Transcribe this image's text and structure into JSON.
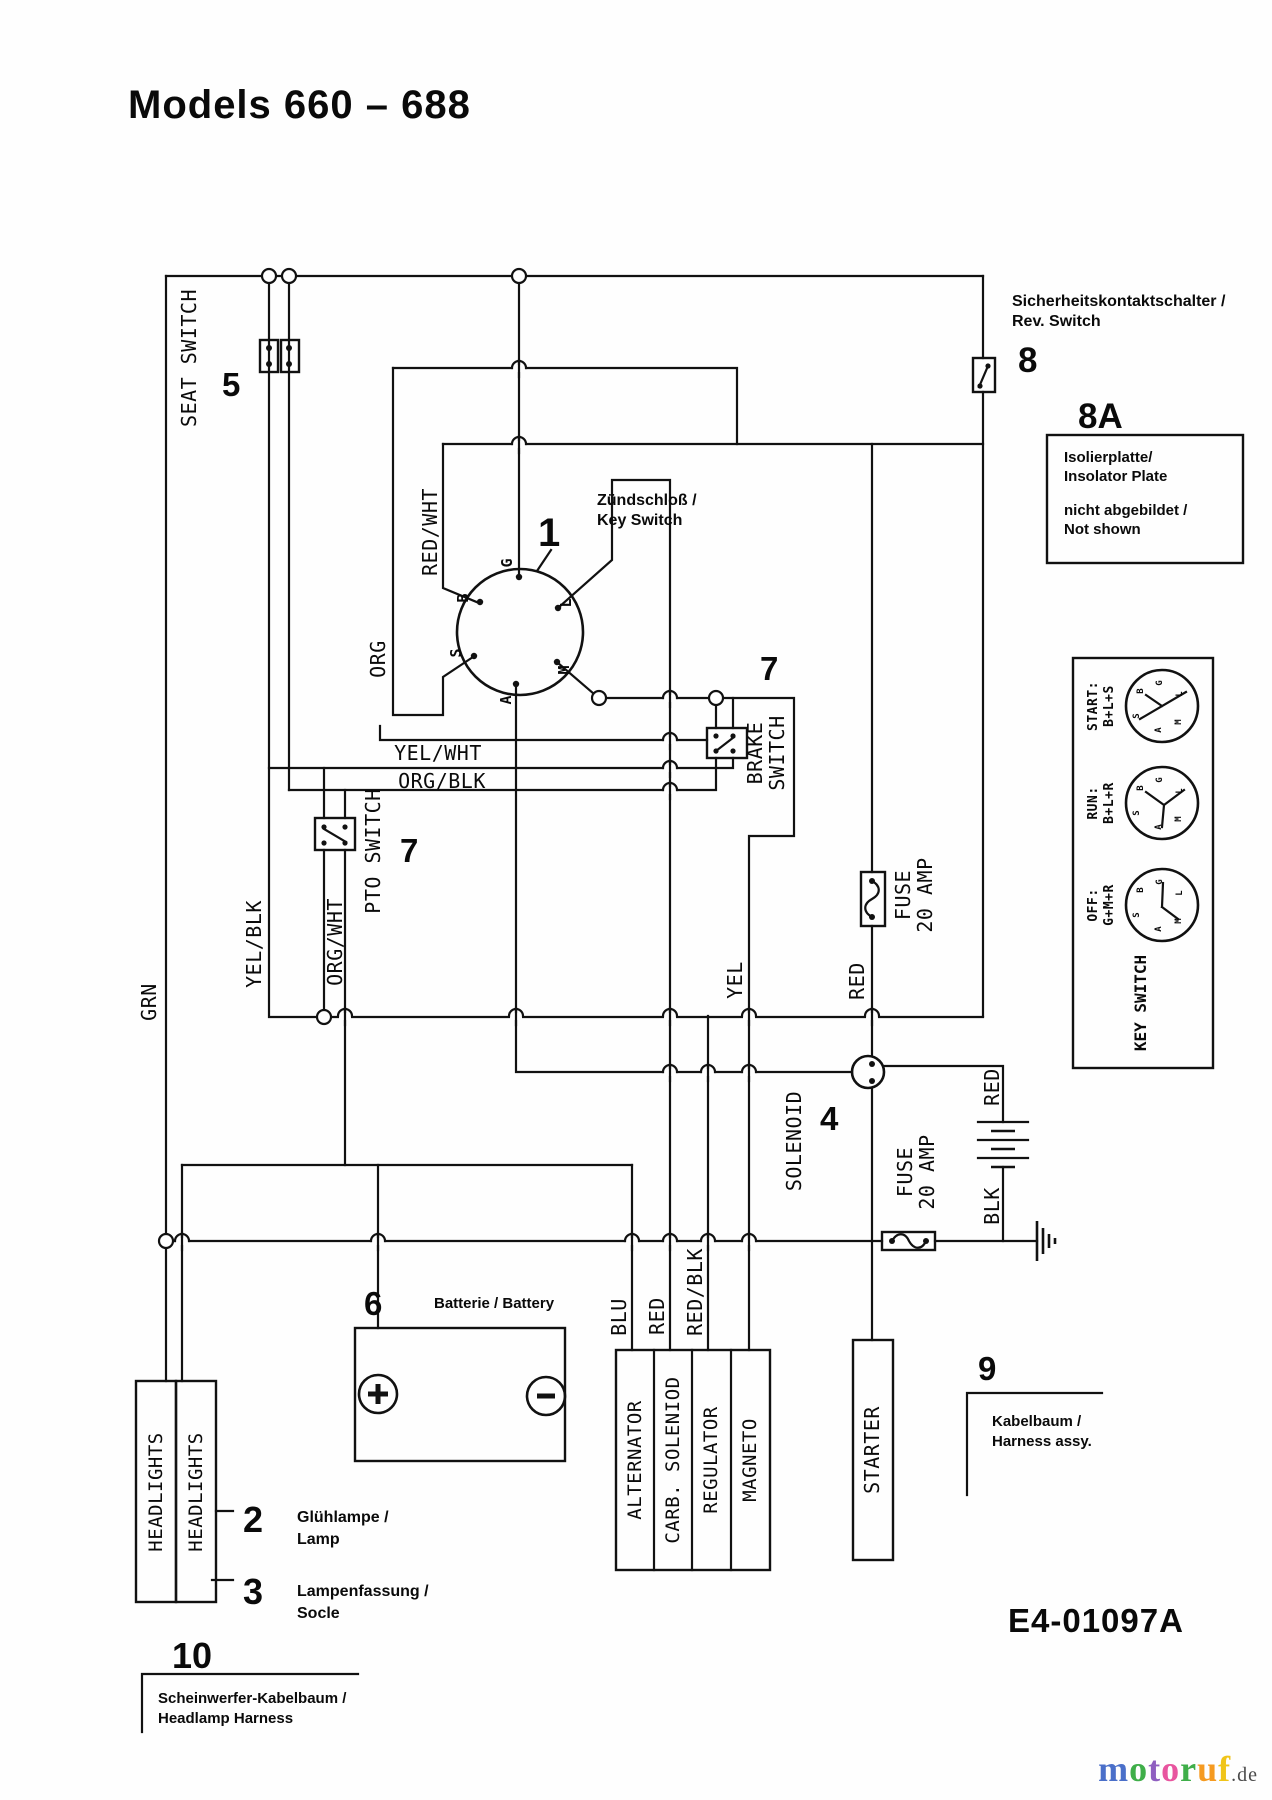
{
  "title": "Models 660 – 688",
  "numbers": {
    "n1": "1",
    "n2": "2",
    "n3": "3",
    "n4": "4",
    "n5": "5",
    "n6": "6",
    "n7_pto": "7",
    "n7_brake": "7",
    "n8": "8",
    "n8a": "8A",
    "n9": "9",
    "n10": "10"
  },
  "labels": {
    "seat_switch": "SEAT SWITCH",
    "grn": "GRN",
    "yel_blk": "YEL/BLK",
    "org_wht": "ORG/WHT",
    "pto_switch": "PTO SWITCH",
    "red_wht": "RED/WHT",
    "org": "ORG",
    "yel_wht": "YEL/WHT",
    "org_blk": "ORG/BLK",
    "brake_1": "BRAKE",
    "brake_2": "SWITCH",
    "yel": "YEL",
    "red_fuse": "RED",
    "fuse1_1": "FUSE",
    "fuse1_2": "20 AMP",
    "fuse2_1": "FUSE",
    "fuse2_2": "20 AMP",
    "solenoid": "SOLENOID",
    "red_bat": "RED",
    "blk": "BLK",
    "blu": "BLU",
    "red_carb": "RED",
    "red_blk": "RED/BLK",
    "alternator": "ALTERNATOR",
    "carb_solenoid": "CARB. SOLENIOD",
    "regulator": "REGULATOR",
    "magneto": "MAGNETO",
    "starter": "STARTER",
    "headlights_1": "HEADLIGHTS",
    "headlights_2": "HEADLIGHTS"
  },
  "key_switch": {
    "terminals": {
      "g": "G",
      "b": "B",
      "l": "L",
      "s": "S",
      "a": "A",
      "m": "M"
    },
    "ann_de": "Zündschloß /",
    "ann_en": "Key Switch"
  },
  "annotations": {
    "rev_de": "Sicherheitskontaktschalter /",
    "rev_en": "Rev. Switch",
    "ins_1": "Isolierplatte/",
    "ins_2": "Insolator Plate",
    "ins_3": "nicht abgebildet /",
    "ins_4": "Not shown",
    "battery": "Batterie / Battery",
    "lamp_de": "Glühlampe /",
    "lamp_en": "Lamp",
    "socket_de": "Lampenfassung /",
    "socket_en": "Socle",
    "harness_de": "Kabelbaum /",
    "harness_en": "Harness assy.",
    "hl_harness_de": "Scheinwerfer-Kabelbaum /",
    "hl_harness_en": "Headlamp Harness",
    "drawing_code": "E4-01097A"
  },
  "key_positions": {
    "box_label": "KEY SWITCH",
    "start_name": "START:",
    "start_terms": "B+L+S",
    "run_name": "RUN:",
    "run_terms": "B+L+R",
    "off_name": "OFF:",
    "off_terms": "G+M+R"
  },
  "watermark": {
    "letters": [
      {
        "ch": "m",
        "style": "color:#4a6fc9"
      },
      {
        "ch": "o",
        "style": "color:#3fae49"
      },
      {
        "ch": "t",
        "style": "color:#8f5fc0"
      },
      {
        "ch": "o",
        "style": "color:#e8559f"
      },
      {
        "ch": "r",
        "style": "color:#3fae49"
      },
      {
        "ch": "u",
        "style": "color:#f59a20"
      },
      {
        "ch": "f",
        "style": "color:#f0c419"
      }
    ],
    "suffix": ".de",
    "suffix_style": "color:#4a4a4a"
  }
}
